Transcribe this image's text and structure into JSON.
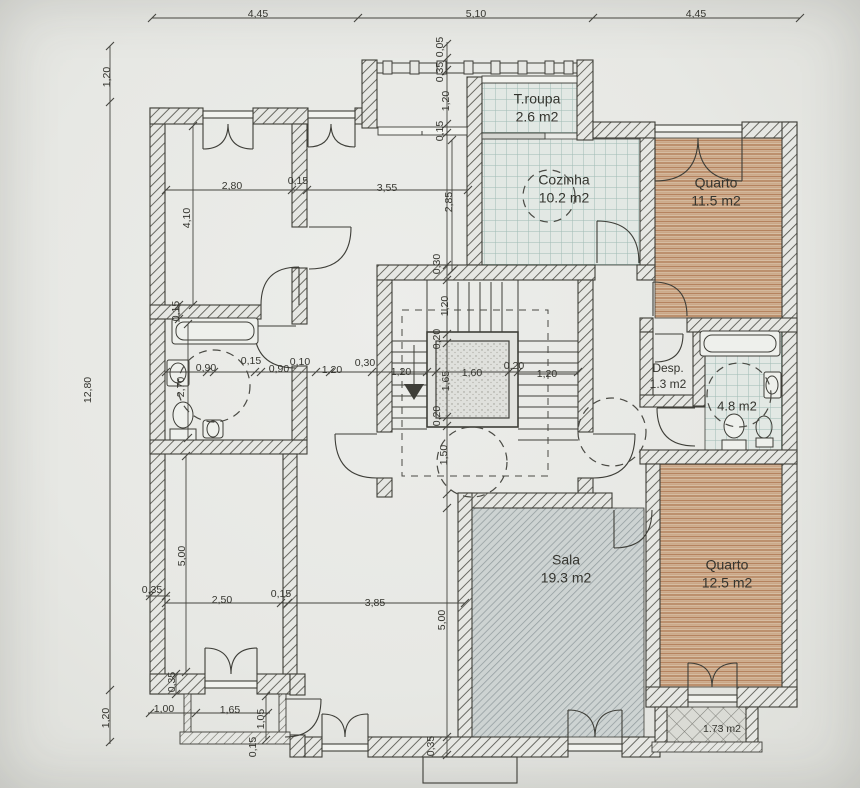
{
  "title": "Floor plan drawing",
  "colors": {
    "paper": "#e8e9e5",
    "ink": "#3e3e38",
    "wall_hatch": "#54544c",
    "tile_line": "#9fbab3",
    "bedroom_stripe": "#b5835f",
    "sala_stripe": "#929c9e",
    "lattice": "#83837d",
    "dashed": "#4a4a44",
    "text": "#35352f"
  },
  "rooms": [
    {
      "name": "t-roupa",
      "label": "T.roupa",
      "area": "2.6 m2",
      "x": 537,
      "y": 100
    },
    {
      "name": "cozinha",
      "label": "Cozinha",
      "area": "10.2 m2",
      "x": 564,
      "y": 181
    },
    {
      "name": "quarto-1",
      "label": "Quarto",
      "area": "11.5 m2",
      "x": 716,
      "y": 184
    },
    {
      "name": "desp",
      "label": "Desp.",
      "area": "1.3 m2",
      "x": 668,
      "y": 369
    },
    {
      "name": "banho",
      "label": "",
      "area": "4.8 m2",
      "x": 737,
      "y": 407
    },
    {
      "name": "sala",
      "label": "Sala",
      "area": "19.3 m2",
      "x": 566,
      "y": 561
    },
    {
      "name": "quarto-2",
      "label": "Quarto",
      "area": "12.5 m2",
      "x": 727,
      "y": 566
    },
    {
      "name": "varanda",
      "label": "",
      "area": "1.73 m2",
      "x": 722,
      "y": 729
    }
  ],
  "dimensions": [
    {
      "text": "4,45",
      "x": 258,
      "y": 14,
      "rot": 0
    },
    {
      "text": "5,10",
      "x": 476,
      "y": 14,
      "rot": 0
    },
    {
      "text": "4,45",
      "x": 696,
      "y": 14,
      "rot": 0
    },
    {
      "text": "1,20",
      "x": 107,
      "y": 77,
      "rot": -90
    },
    {
      "text": "12,80",
      "x": 88,
      "y": 390,
      "rot": -90
    },
    {
      "text": "1,20",
      "x": 106,
      "y": 718,
      "rot": -90
    },
    {
      "text": "0,05",
      "x": 440,
      "y": 47,
      "rot": -90
    },
    {
      "text": "0,35",
      "x": 440,
      "y": 72,
      "rot": -90
    },
    {
      "text": "1,20",
      "x": 446,
      "y": 101,
      "rot": -90
    },
    {
      "text": "0,15",
      "x": 440,
      "y": 131,
      "rot": -90
    },
    {
      "text": "2,85",
      "x": 449,
      "y": 202,
      "rot": -90
    },
    {
      "text": "0,30",
      "x": 437,
      "y": 264,
      "rot": -90
    },
    {
      "text": "1,20",
      "x": 445,
      "y": 306,
      "rot": -90
    },
    {
      "text": "0,20",
      "x": 437,
      "y": 339,
      "rot": -90
    },
    {
      "text": "1,65",
      "x": 446,
      "y": 381,
      "rot": -90
    },
    {
      "text": "0,20",
      "x": 437,
      "y": 416,
      "rot": -90
    },
    {
      "text": "1,50",
      "x": 444,
      "y": 455,
      "rot": -90
    },
    {
      "text": "5,00",
      "x": 442,
      "y": 620,
      "rot": -90
    },
    {
      "text": "0,35",
      "x": 431,
      "y": 746,
      "rot": -90
    },
    {
      "text": "2,80",
      "x": 232,
      "y": 186,
      "rot": 0
    },
    {
      "text": "0,15",
      "x": 298,
      "y": 181,
      "rot": 0
    },
    {
      "text": "3,55",
      "x": 387,
      "y": 188,
      "rot": 0
    },
    {
      "text": "4,10",
      "x": 187,
      "y": 218,
      "rot": -90
    },
    {
      "text": "0,15",
      "x": 176,
      "y": 311,
      "rot": -90
    },
    {
      "text": "2,70",
      "x": 181,
      "y": 387,
      "rot": -90
    },
    {
      "text": "0,90",
      "x": 206,
      "y": 368,
      "rot": 0
    },
    {
      "text": "0,15",
      "x": 251,
      "y": 361,
      "rot": 0
    },
    {
      "text": "0,90",
      "x": 279,
      "y": 369,
      "rot": 0
    },
    {
      "text": "0,10",
      "x": 300,
      "y": 362,
      "rot": 0
    },
    {
      "text": "1,20",
      "x": 332,
      "y": 370,
      "rot": 0
    },
    {
      "text": "0,30",
      "x": 365,
      "y": 363,
      "rot": 0
    },
    {
      "text": "1,20",
      "x": 401,
      "y": 372,
      "rot": 0
    },
    {
      "text": "1,60",
      "x": 472,
      "y": 373,
      "rot": 0
    },
    {
      "text": "0,20",
      "x": 514,
      "y": 366,
      "rot": 0
    },
    {
      "text": "1,20",
      "x": 547,
      "y": 374,
      "rot": 0
    },
    {
      "text": "0,35",
      "x": 152,
      "y": 590,
      "rot": 0
    },
    {
      "text": "2,50",
      "x": 222,
      "y": 600,
      "rot": 0
    },
    {
      "text": "0,15",
      "x": 281,
      "y": 594,
      "rot": 0
    },
    {
      "text": "3,85",
      "x": 375,
      "y": 603,
      "rot": 0
    },
    {
      "text": "5,00",
      "x": 182,
      "y": 556,
      "rot": -90
    },
    {
      "text": "0,35",
      "x": 172,
      "y": 682,
      "rot": -90
    },
    {
      "text": "1,00",
      "x": 164,
      "y": 709,
      "rot": 0
    },
    {
      "text": "1,65",
      "x": 230,
      "y": 710,
      "rot": 0
    },
    {
      "text": "1,05",
      "x": 261,
      "y": 719,
      "rot": -90
    },
    {
      "text": "0,15",
      "x": 253,
      "y": 747,
      "rot": -90
    }
  ]
}
